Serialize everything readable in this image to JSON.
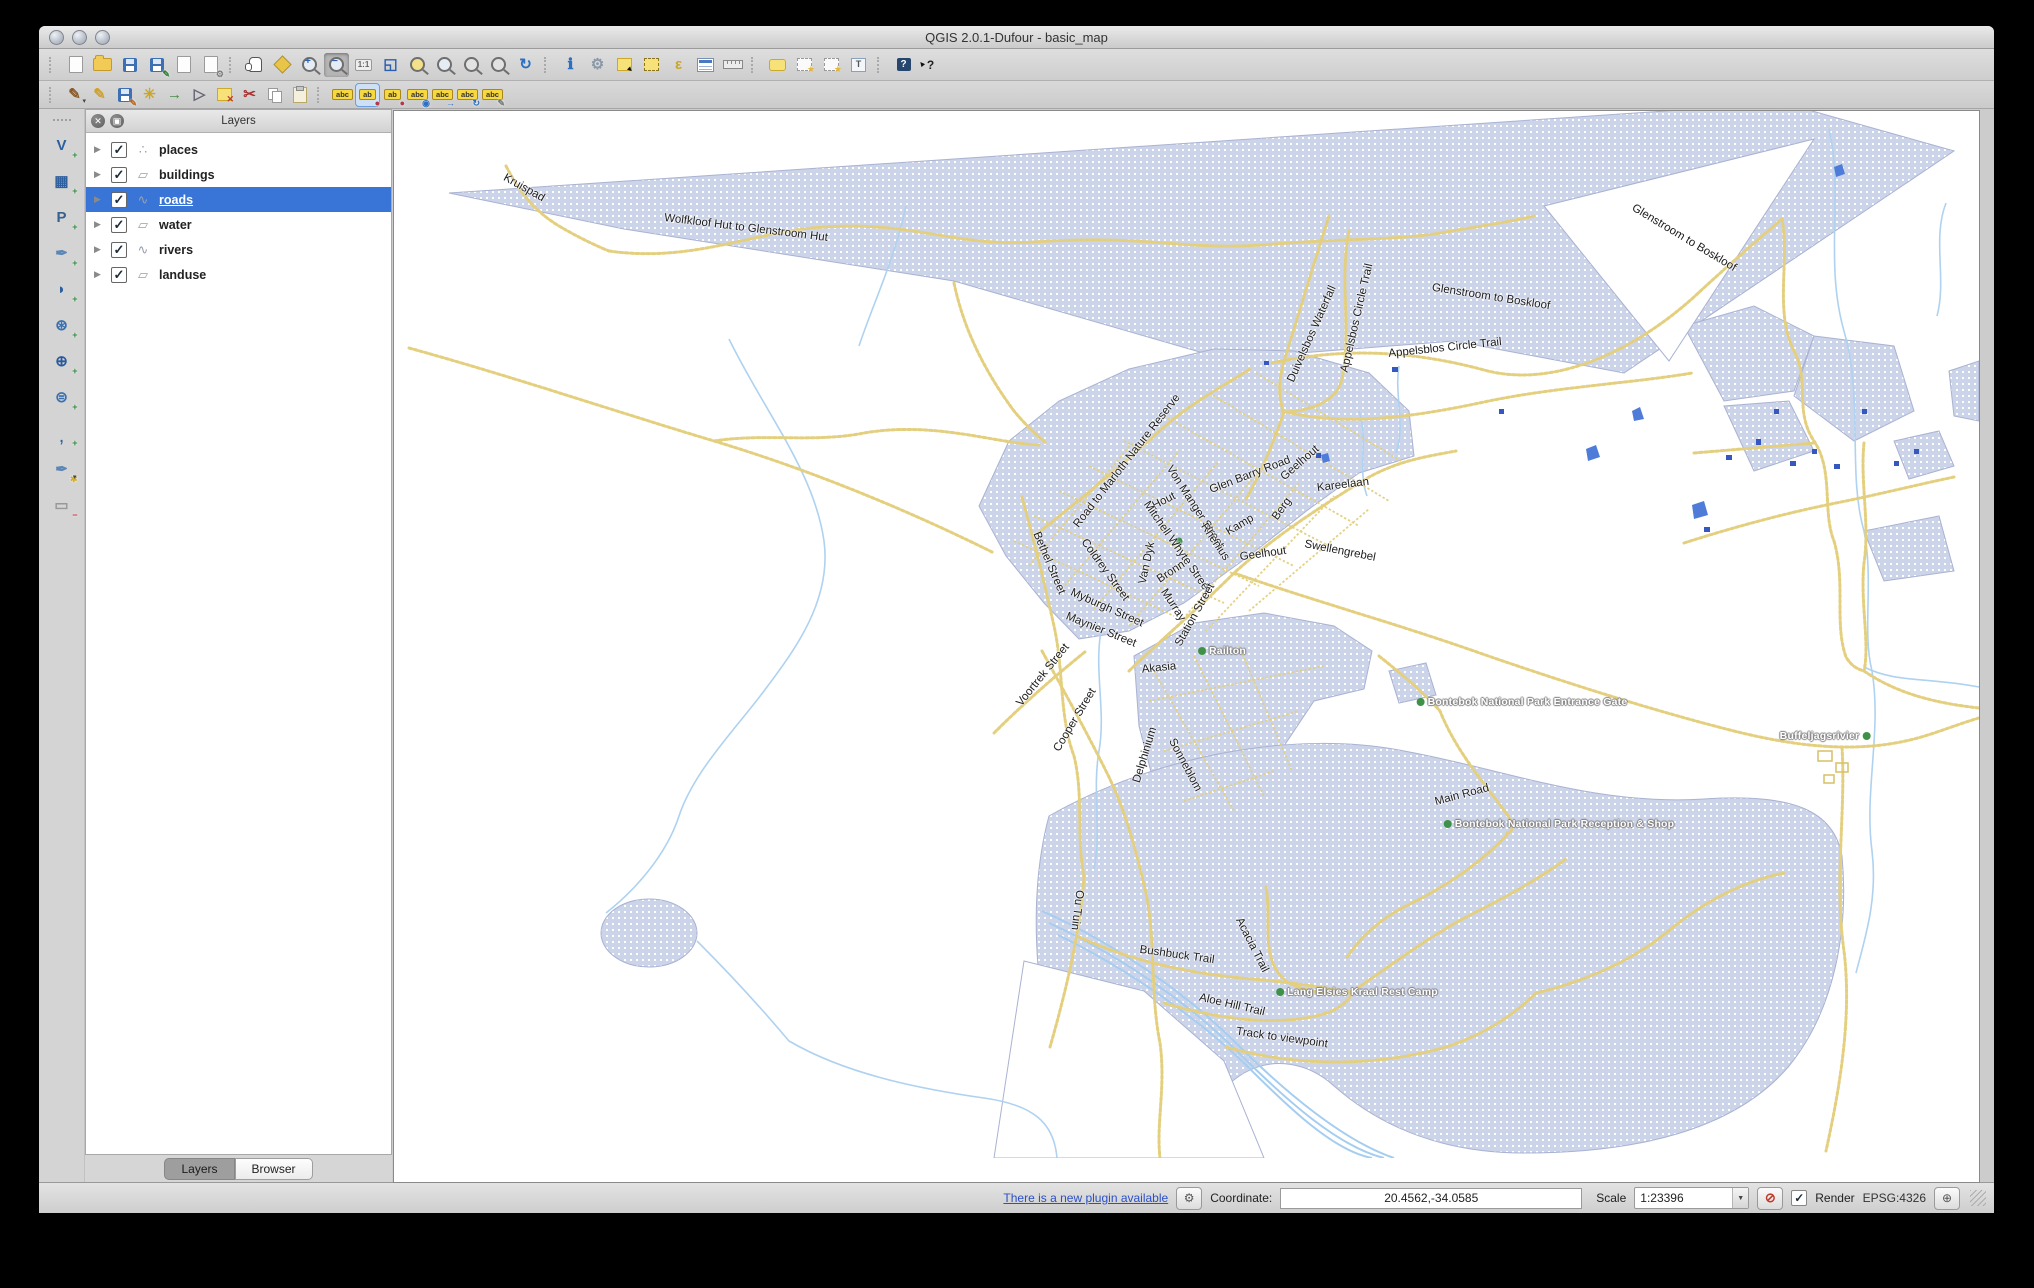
{
  "window": {
    "title": "QGIS 2.0.1-Dufour - basic_map"
  },
  "colors": {
    "selection": "#3875d7",
    "landuse": "#ccd4ea",
    "road": "#e3cf7d",
    "river": "#aed2f0",
    "building": "#3558c0",
    "place_dot": "#3f9148"
  },
  "toolbar_row1": [
    {
      "sep": true
    },
    {
      "name": "new-project",
      "cls": "i-page"
    },
    {
      "name": "open-project",
      "cls": "i-folder"
    },
    {
      "name": "save-project",
      "cls": "i-floppy"
    },
    {
      "name": "save-project-as",
      "cls": "i-floppy",
      "badge": "✎",
      "badgeColor": "#2e7d32"
    },
    {
      "name": "new-print-composer",
      "cls": "i-page"
    },
    {
      "name": "composer-manager",
      "cls": "i-page",
      "badge": "⚙",
      "badgeColor": "#777"
    },
    {
      "sep": true
    },
    {
      "name": "pan-map",
      "cls": "i-hand"
    },
    {
      "name": "pan-map-to-selection",
      "cls": "i-pansel"
    },
    {
      "name": "zoom-in",
      "cls": "i-zoom zin"
    },
    {
      "name": "zoom-out",
      "cls": "i-zoom zout",
      "pressed": true
    },
    {
      "name": "zoom-native",
      "cls": "i-txt",
      "glyph": "1:1"
    },
    {
      "name": "zoom-full",
      "glyph": "◱",
      "color": "#2b5fae",
      "cls": "i-big"
    },
    {
      "name": "zoom-to-selection",
      "cls": "i-zoom zsel"
    },
    {
      "name": "zoom-to-layer",
      "cls": "i-zoom"
    },
    {
      "name": "zoom-last",
      "cls": "i-zoom zgray"
    },
    {
      "name": "zoom-next",
      "cls": "i-zoom zgray"
    },
    {
      "name": "refresh",
      "glyph": "↻",
      "color": "#2b6fc0",
      "cls": "i-big"
    },
    {
      "sep": true
    },
    {
      "name": "identify-features",
      "glyph": "ℹ",
      "color": "#2b6fc0",
      "cls": "i-big"
    },
    {
      "name": "run-feature-action",
      "glyph": "⚙",
      "color": "#8a98a8",
      "cls": "i-big"
    },
    {
      "name": "select-features-rectangle",
      "cls": "i-selrect"
    },
    {
      "name": "deselect-features",
      "cls": "i-seldash"
    },
    {
      "name": "select-by-expression",
      "glyph": "ε",
      "color": "#c9a52a",
      "cls": "i-big"
    },
    {
      "name": "open-attribute-table",
      "cls": "i-table"
    },
    {
      "name": "measure-line",
      "cls": "i-ruler"
    },
    {
      "sep": true
    },
    {
      "name": "map-tips",
      "cls": "i-tip"
    },
    {
      "name": "new-bookmark",
      "cls": "i-bmark"
    },
    {
      "name": "show-bookmarks",
      "cls": "i-bmark"
    },
    {
      "name": "text-annotation",
      "cls": "i-annot",
      "glyph": "T"
    },
    {
      "sep": true
    },
    {
      "name": "help-contents",
      "cls": "i-help",
      "glyph": "?"
    },
    {
      "name": "whats-this",
      "cls": "i-whats",
      "glyph": "?"
    }
  ],
  "toolbar_row2": [
    {
      "sep": true
    },
    {
      "name": "current-edits",
      "glyph": "✎",
      "color": "#8a5a2a",
      "cls": "i-big",
      "caret": true
    },
    {
      "name": "toggle-editing",
      "glyph": "✎",
      "color": "#d0a22c",
      "cls": "i-big"
    },
    {
      "name": "save-layer-edits",
      "cls": "i-floppy",
      "badge": "✎",
      "badgeColor": "#b5651d"
    },
    {
      "name": "add-feature",
      "glyph": "✳",
      "color": "#caa52a",
      "cls": "i-big"
    },
    {
      "name": "move-feature",
      "glyph": "→",
      "color": "#4a8b4a",
      "cls": "i-big"
    },
    {
      "name": "node-tool",
      "glyph": "▷",
      "color": "#667",
      "cls": "i-big"
    },
    {
      "name": "delete-selected",
      "cls": "i-delsel"
    },
    {
      "name": "cut-features",
      "glyph": "✂",
      "color": "#a33",
      "cls": "i-big"
    },
    {
      "name": "copy-features",
      "cls": "i-copy"
    },
    {
      "name": "paste-features",
      "cls": "i-paste"
    },
    {
      "sep": true
    },
    {
      "name": "labeling",
      "cls": "i-tag",
      "glyph": "abc"
    },
    {
      "name": "pin-unpin-labels",
      "cls": "i-tag",
      "glyph": "ab",
      "badge": "●",
      "badgeColor": "#b23a48",
      "framed": true
    },
    {
      "name": "highlight-pinned-labels",
      "cls": "i-tag",
      "glyph": "ab",
      "badge": "●",
      "badgeColor": "#b23a48"
    },
    {
      "name": "show-hide-labels",
      "cls": "i-tag",
      "glyph": "abc",
      "badge": "◉",
      "badgeColor": "#2b6fc0"
    },
    {
      "name": "move-label",
      "cls": "i-tag",
      "glyph": "abc",
      "badge": "→",
      "badgeColor": "#2b6fc0"
    },
    {
      "name": "rotate-label",
      "cls": "i-tag",
      "glyph": "abc",
      "badge": "↻",
      "badgeColor": "#2b6fc0"
    },
    {
      "name": "change-label-properties",
      "cls": "i-tag",
      "glyph": "abc",
      "badge": "✎",
      "badgeColor": "#777"
    }
  ],
  "left_toolbar": [
    {
      "name": "add-vector-layer",
      "glyph": "V",
      "color": "#2d5f9e",
      "badge": "+",
      "badgeColor": "#2e8b3d",
      "cls": "i-big"
    },
    {
      "name": "add-raster-layer",
      "glyph": "▦",
      "color": "#2d5f9e",
      "badge": "+",
      "badgeColor": "#2e8b3d",
      "cls": "i-big"
    },
    {
      "name": "add-postgis-layer",
      "glyph": "P",
      "color": "#36618e",
      "badge": "+",
      "badgeColor": "#2e8b3d",
      "cls": "i-big"
    },
    {
      "name": "add-spatialite-layer",
      "glyph": "✒",
      "color": "#5b86b5",
      "badge": "+",
      "badgeColor": "#2e8b3d",
      "cls": "i-big"
    },
    {
      "name": "add-mssql-layer",
      "glyph": "◗",
      "color": "#2d5f9e",
      "badge": "+",
      "badgeColor": "#2e8b3d",
      "cls": "i-big"
    },
    {
      "name": "add-wms-layer",
      "glyph": "⊛",
      "color": "#3a6fb0",
      "badge": "+",
      "badgeColor": "#2e8b3d",
      "cls": "i-big"
    },
    {
      "name": "add-wcs-layer",
      "glyph": "⊕",
      "color": "#2a5a9e",
      "badge": "+",
      "badgeColor": "#2e8b3d",
      "cls": "i-big"
    },
    {
      "name": "add-wfs-layer",
      "glyph": "⊜",
      "color": "#3a6fb0",
      "badge": "+",
      "badgeColor": "#2e8b3d",
      "cls": "i-big"
    },
    {
      "name": "add-delimited-text-layer",
      "glyph": ",",
      "color": "#2d5f9e",
      "cls": "i-comma",
      "badge": "+",
      "badgeColor": "#2e8b3d"
    },
    {
      "name": "new-shapefile-layer",
      "glyph": "✒",
      "color": "#5b86b5",
      "badge": "✱",
      "badgeColor": "#d4af2a",
      "caret": true,
      "cls": "i-big"
    },
    {
      "name": "remove-layer",
      "glyph": "▭",
      "color": "#999",
      "badge": "−",
      "badgeColor": "#c33",
      "cls": "i-big"
    }
  ],
  "layers_panel": {
    "title": "Layers",
    "layers": [
      {
        "label": "places",
        "type": "point",
        "checked": true,
        "selected": false
      },
      {
        "label": "buildings",
        "type": "polygon",
        "checked": true,
        "selected": false
      },
      {
        "label": "roads",
        "type": "line",
        "checked": true,
        "selected": true
      },
      {
        "label": "water",
        "type": "polygon",
        "checked": true,
        "selected": false
      },
      {
        "label": "rivers",
        "type": "line",
        "checked": true,
        "selected": false
      },
      {
        "label": "landuse",
        "type": "polygon",
        "checked": true,
        "selected": false
      }
    ],
    "tabs": [
      {
        "label": "Layers",
        "active": true
      },
      {
        "label": "Browser",
        "active": false
      }
    ]
  },
  "statusbar": {
    "plugin_link": "There is a new plugin available",
    "coordinate_label": "Coordinate:",
    "coordinate_value": "20.4562,-34.0585",
    "scale_label": "Scale",
    "scale_value": "1:23396",
    "render_label": "Render",
    "render_checked": "✓",
    "crs": "EPSG:4326"
  },
  "map": {
    "labels": [
      {
        "t": "Kruispad",
        "x": 130,
        "y": 77,
        "r": 29,
        "k": "r"
      },
      {
        "t": "Wolfkloof Hut to Glenstroom Hut",
        "x": 352,
        "y": 117,
        "r": 7,
        "k": "r"
      },
      {
        "t": "Glenstroom to Boskloof",
        "x": 1290,
        "y": 127,
        "r": 31,
        "k": "r"
      },
      {
        "t": "Glenstroom to Boskloof",
        "x": 1097,
        "y": 186,
        "r": 9,
        "k": "r"
      },
      {
        "t": "Duivelsbos Waterfall",
        "x": 918,
        "y": 223,
        "r": -66,
        "k": "r"
      },
      {
        "t": "Appelsbos Circle Trail",
        "x": 963,
        "y": 207,
        "r": -77,
        "k": "r"
      },
      {
        "t": "Appelsblos Circle Trail",
        "x": 1051,
        "y": 237,
        "r": -6,
        "k": "r"
      },
      {
        "t": "Road to Marloth Nature Reserve",
        "x": 733,
        "y": 350,
        "r": -52,
        "k": "r"
      },
      {
        "t": "Hout",
        "x": 770,
        "y": 390,
        "r": -27,
        "k": "r"
      },
      {
        "t": "Von Manger Street",
        "x": 801,
        "y": 396,
        "r": 57,
        "k": "r"
      },
      {
        "t": "Glen Barry Road",
        "x": 856,
        "y": 364,
        "r": -21,
        "k": "r"
      },
      {
        "t": "Geelhout",
        "x": 906,
        "y": 352,
        "r": -41,
        "k": "r"
      },
      {
        "t": "Kareelaan",
        "x": 949,
        "y": 374,
        "r": -7,
        "k": "r"
      },
      {
        "t": "Mitchell Whyte Street",
        "x": 783,
        "y": 436,
        "r": 55,
        "k": "r"
      },
      {
        "t": "Kamp",
        "x": 846,
        "y": 414,
        "r": -31,
        "k": "r"
      },
      {
        "t": "Berg",
        "x": 888,
        "y": 398,
        "r": -54,
        "k": "r"
      },
      {
        "t": "Rhenius",
        "x": 821,
        "y": 431,
        "r": 56,
        "k": "r"
      },
      {
        "t": "Swellengrebel",
        "x": 946,
        "y": 440,
        "r": 11,
        "k": "r"
      },
      {
        "t": "Coldrey Street",
        "x": 711,
        "y": 459,
        "r": 54,
        "k": "r"
      },
      {
        "t": "Van Dyk",
        "x": 753,
        "y": 452,
        "r": -78,
        "k": "r"
      },
      {
        "t": "Bronn",
        "x": 777,
        "y": 461,
        "r": -33,
        "k": "r"
      },
      {
        "t": "Geelhout",
        "x": 869,
        "y": 443,
        "r": -8,
        "k": "r"
      },
      {
        "t": "Bethel Street",
        "x": 655,
        "y": 452,
        "r": 67,
        "k": "r"
      },
      {
        "t": "Myburgh Street",
        "x": 713,
        "y": 497,
        "r": 24,
        "k": "r"
      },
      {
        "t": "Murray",
        "x": 779,
        "y": 494,
        "r": 57,
        "k": "r"
      },
      {
        "t": "Station Street",
        "x": 801,
        "y": 504,
        "r": -61,
        "k": "r"
      },
      {
        "t": "Maynier Street",
        "x": 707,
        "y": 519,
        "r": 22,
        "k": "r"
      },
      {
        "t": "Voortrek Street",
        "x": 649,
        "y": 564,
        "r": -51,
        "k": "r"
      },
      {
        "t": "Akasia",
        "x": 765,
        "y": 557,
        "r": -6,
        "k": "r"
      },
      {
        "t": "Cooper Street",
        "x": 681,
        "y": 609,
        "r": -59,
        "k": "r"
      },
      {
        "t": "Delphinium",
        "x": 751,
        "y": 644,
        "r": -73,
        "k": "r"
      },
      {
        "t": "Sonneblom",
        "x": 791,
        "y": 654,
        "r": 62,
        "k": "r"
      },
      {
        "t": "Main Road",
        "x": 1068,
        "y": 684,
        "r": -15,
        "k": "r"
      },
      {
        "t": "Ou Tuin",
        "x": 683,
        "y": 799,
        "r": 97,
        "k": "r"
      },
      {
        "t": "Bushbuck Trail",
        "x": 783,
        "y": 844,
        "r": 8,
        "k": "r"
      },
      {
        "t": "Acacia Trail",
        "x": 858,
        "y": 834,
        "r": 63,
        "k": "r"
      },
      {
        "t": "Aloe Hill Trail",
        "x": 838,
        "y": 894,
        "r": 13,
        "k": "r"
      },
      {
        "t": "Track to viewpoint",
        "x": 888,
        "y": 927,
        "r": 8,
        "k": "r"
      },
      {
        "t": "Railton",
        "x": 828,
        "y": 540,
        "r": 0,
        "k": "p",
        "dot": "l"
      },
      {
        "t": "Bontebok National Park Entrance Gate",
        "x": 1128,
        "y": 591,
        "r": 0,
        "k": "p",
        "dot": "l"
      },
      {
        "t": "Buffeljagsrivier",
        "x": 1431,
        "y": 625,
        "r": 0,
        "k": "p",
        "dot": "r"
      },
      {
        "t": "Bontebok National Park Reception & Shop",
        "x": 1165,
        "y": 713,
        "r": 0,
        "k": "p",
        "dot": "l"
      },
      {
        "t": "Lang Elsies Kraal Rest Camp",
        "x": 963,
        "y": 881,
        "r": 0,
        "k": "p",
        "dot": "l"
      }
    ]
  }
}
